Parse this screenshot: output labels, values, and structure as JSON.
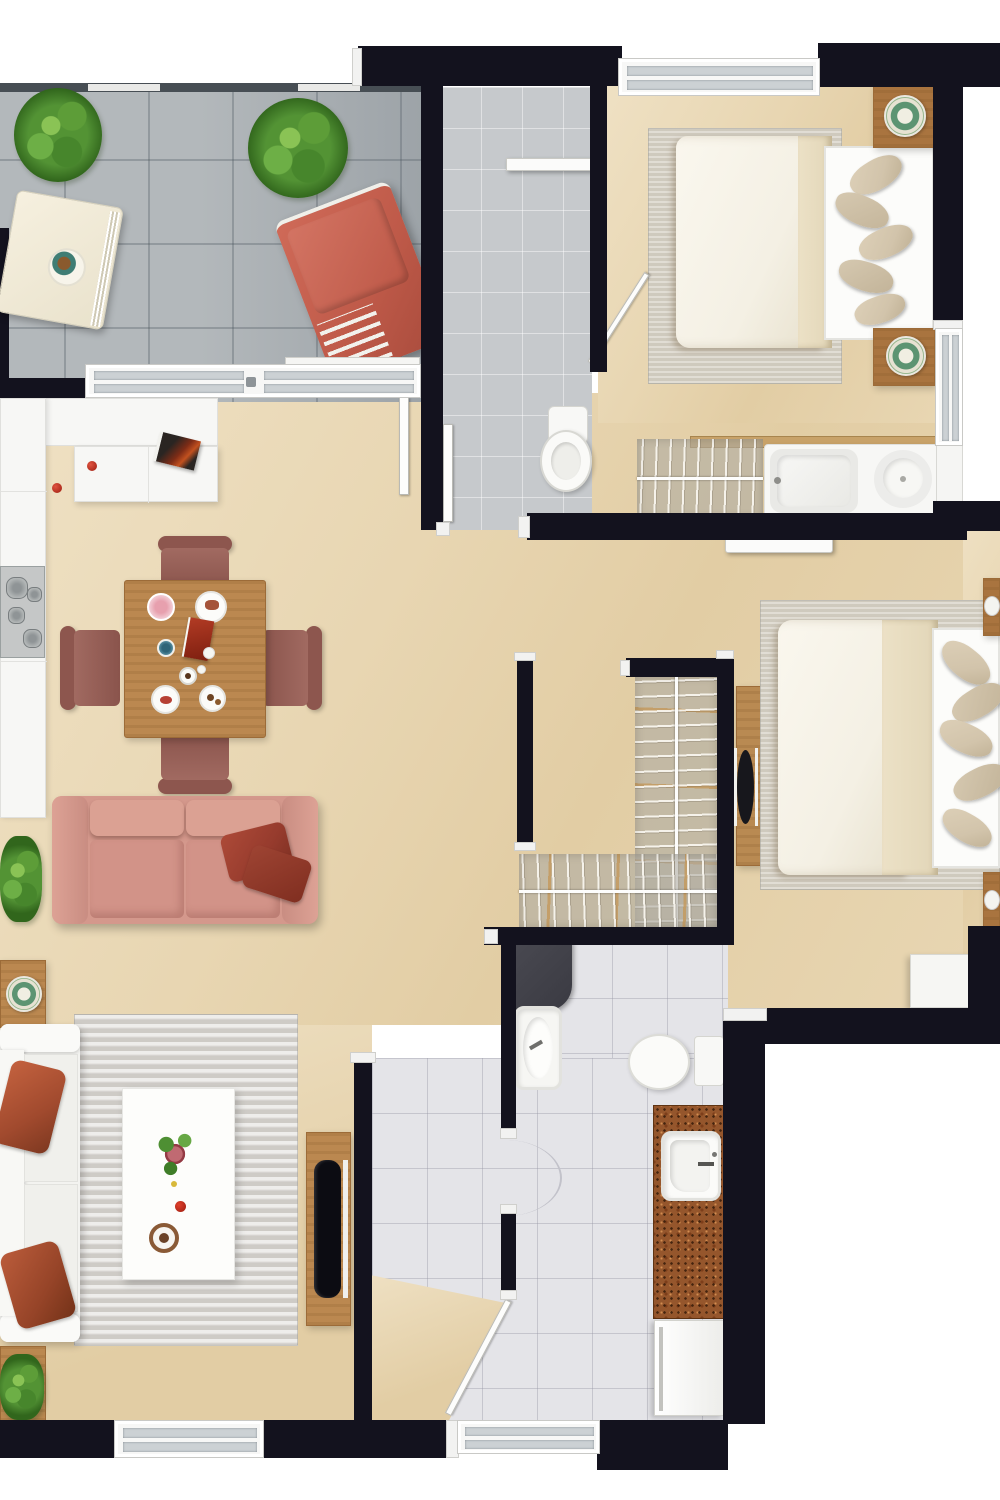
{
  "meta": {
    "title": "apartment-floor-plan-top-view",
    "view": "top-down 3D rendered floor plan",
    "canvas": {
      "width": 1000,
      "height": 1500
    },
    "visible_text": []
  },
  "palette": {
    "wall": "#13121e",
    "beige": "#e8d6b2",
    "beige-light": "#efe1c4",
    "beige-warm": "#e2cda4",
    "balcony-tile": "#b3b8bb",
    "laundry-tile": "#c6c9cc",
    "bath-tile": "#e4e4e8",
    "glass": "#ccd1d4",
    "wood": "#bb8850",
    "wood-dark": "#9c6b38",
    "nightstand-wood": "#a9743f",
    "sofa-pink": "#d4988c",
    "sofa-pink-light": "#dda295",
    "pillow-red": "#963b2d",
    "lounge-red": "#bf5a49",
    "chair-mauve": "#a16a61",
    "chair-mauve-dark": "#8d564e",
    "cream": "#f1ead7",
    "rug-gray": "#dcdad6",
    "rug-warm": "#d7d1c5",
    "bed-duvet": "#f4f0e4",
    "bed-blanket": "#e2d6b8",
    "pillow-tan": "#d2c4ab",
    "counter-brown": "#95562c",
    "plant-green": "#559238",
    "plant-green-dark": "#33651f",
    "stove-gray": "#c5c7c7",
    "tv-black": "#0c0c12",
    "shower-screen": "#3a3a42"
  },
  "rooms": [
    {
      "id": "balcony",
      "name": "Balcony terrace",
      "floor": "gray tile",
      "furniture": [
        "potted-plant",
        "palm-plant",
        "cream-sun-lounger",
        "lounger-tray",
        "terracotta-outdoor-chaise",
        "railing",
        "sliding-glass-windows"
      ]
    },
    {
      "id": "kitchen",
      "name": "Kitchen",
      "floor": "beige",
      "furniture": [
        "white-counter-L",
        "peninsula-counter",
        "cooktop-4-burners",
        "cookbook-tray",
        "tomatoes",
        "tall-cabinet-door"
      ]
    },
    {
      "id": "dining",
      "name": "Dining area",
      "floor": "beige",
      "furniture": [
        "square-wood-table",
        "four-mauve-chairs",
        "plates-and-cups"
      ]
    },
    {
      "id": "living",
      "name": "Living room",
      "floor": "beige",
      "furniture": [
        "pink-two-seat-sofa",
        "two-dark-red-throw-pillows",
        "white-sofa",
        "gray-area-rug",
        "white-coffee-table",
        "flower-centerpiece",
        "tv-console",
        "flat-tv",
        "wooden-side-table",
        "floor-plants"
      ]
    },
    {
      "id": "bedroom-1",
      "name": "Bedroom 1 (top right)",
      "floor": "beige",
      "furniture": [
        "double-bed-cream-duvet",
        "tan-pillows",
        "two-wood-nightstands",
        "decorative-plates",
        "area-rug",
        "window",
        "swing-door"
      ]
    },
    {
      "id": "laundry",
      "name": "Laundry / utility room",
      "floor": "small gray tile",
      "furniture": [
        "wall-shelf",
        "door-leaf"
      ]
    },
    {
      "id": "wc",
      "name": "WC (top)",
      "floor": "small gray tile",
      "furniture": [
        "toilet",
        "door-leaf"
      ]
    },
    {
      "id": "bathroom-1",
      "name": "Bathroom strip (top)",
      "floor": "beige",
      "furniture": [
        "drying-rack-with-towels",
        "white-vanity",
        "bathtub",
        "round-basin",
        "tall-white-cabinet"
      ]
    },
    {
      "id": "closet",
      "name": "Walk-in closet",
      "floor": "beige",
      "furniture": [
        "vertical-clothes-rack",
        "horizontal-clothes-rack",
        "wood-sliding-door-with-black-handle"
      ]
    },
    {
      "id": "bedroom-2",
      "name": "Bedroom 2 (right)",
      "floor": "beige",
      "furniture": [
        "double-bed-cream-duvet",
        "tan-pillows",
        "two-wood-nightstands",
        "white-dresser",
        "area-rug",
        "wall-shelf-rail"
      ]
    },
    {
      "id": "bathroom-2",
      "name": "Bathroom (center bottom)",
      "floor": "white tile",
      "furniture": [
        "dark-shower-screen",
        "washbasin",
        "toilet",
        "brown-granite-vanity",
        "inset-sink",
        "white-washer"
      ]
    },
    {
      "id": "entry",
      "name": "Entry hall",
      "floor": "white tile + beige threshold",
      "furniture": [
        "entry-door-open",
        "door-swing-arc",
        "bottom-windows"
      ]
    }
  ]
}
